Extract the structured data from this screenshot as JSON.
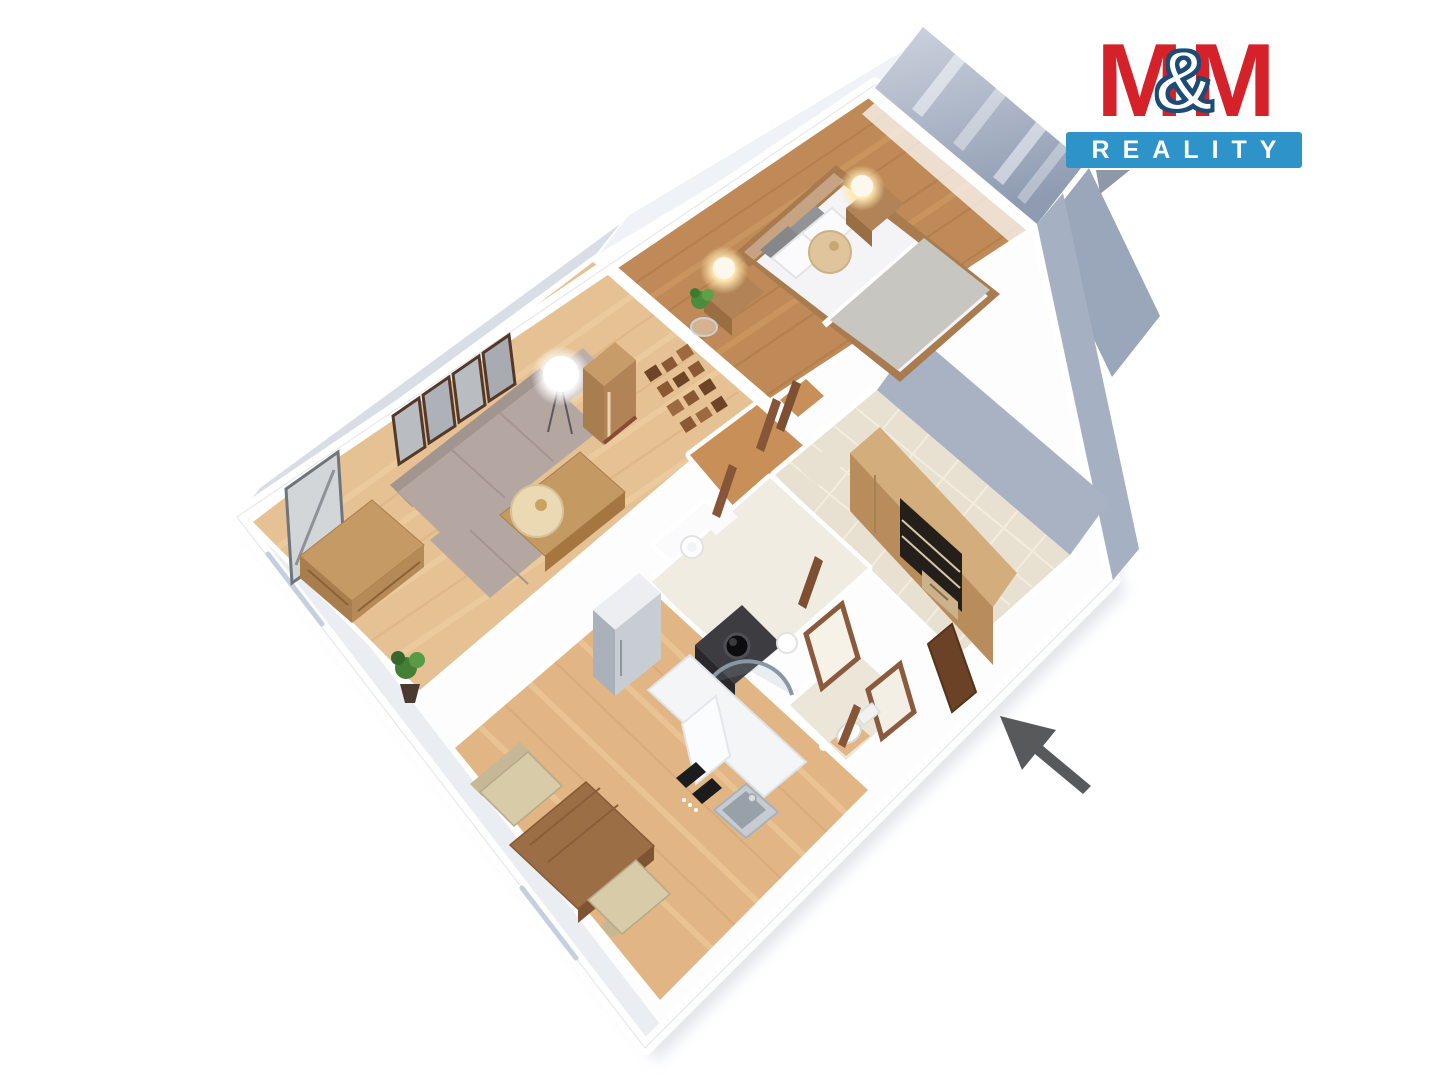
{
  "logo": {
    "m1": "M",
    "amp": "&",
    "m2": "M",
    "subtitle": "REALITY"
  },
  "colors": {
    "logo_red": "#d4212a",
    "logo_blue": "#2e93c8",
    "amp_outline": "#1d4b73",
    "logo_tail": "#8e98a9",
    "arrow": "#58595b",
    "wall_panel": "#9aa6ba",
    "wall_panel_light": "#c7cdd9",
    "wall_white": "#ffffff",
    "floor_bedroom": "#bf8a57",
    "floor_living": "#e6c193",
    "floor_kitchen": "#e2b584",
    "floor_hall_tile": "#e8e1d2",
    "floor_bath": "#f0ece2",
    "floor_wc": "#ece6d8",
    "floor_closet": "#fbfbfc",
    "floor_hallway_wood": "#c89058",
    "sofa": "#b4a7a2",
    "wood_furniture": "#b28357",
    "wardrobe_front": "#b98d5b",
    "bed_mattress": "#f4f3f5",
    "vanity": "#3d3d41",
    "door_wood": "#7d4f33"
  }
}
